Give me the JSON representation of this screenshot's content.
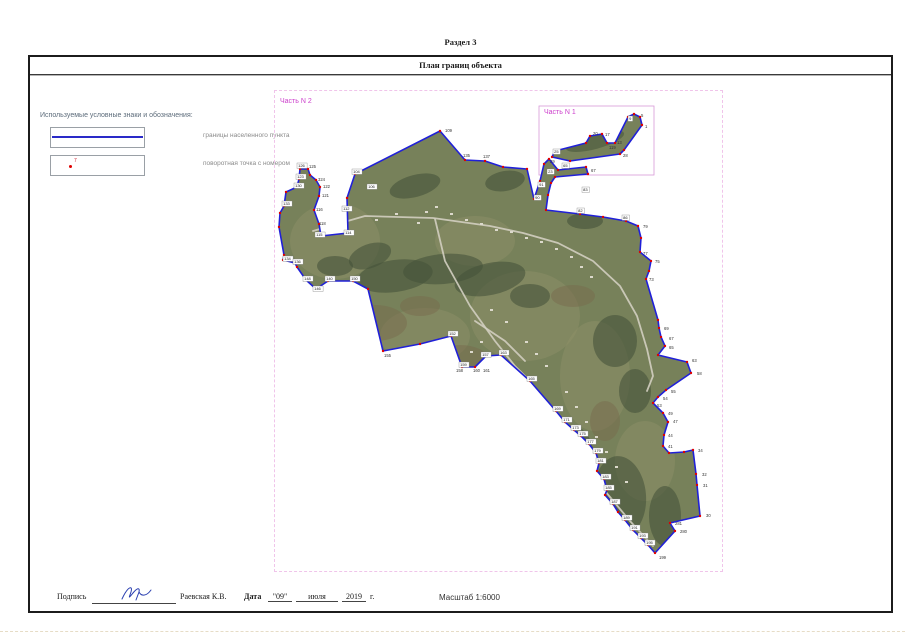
{
  "page": {
    "section_title": "Раздел 3",
    "band_title": "План границ объекта"
  },
  "legend": {
    "title": "Используемые условные знаки и обозначения:",
    "items": [
      {
        "label": "границы населенного пункта",
        "symbol": "boundary-line"
      },
      {
        "label": "поворотная точка с номером",
        "symbol": "turn-point",
        "point_number": "7"
      }
    ]
  },
  "map": {
    "part2_label": "Часть N 2",
    "part1_label": "Часть N 1",
    "colors": {
      "frame": "#f0c4ea",
      "part1_box": "#d898d8",
      "boundary": "#2020d8",
      "point": "#e00000",
      "base": "#77815a",
      "field": "#8d9067",
      "patch": "#77684c",
      "forest": "#46543a",
      "road": "#d2cec0",
      "building": "#dcd9cc"
    },
    "part1_box": {
      "x": 264,
      "y": 15,
      "w": 115,
      "h": 69
    },
    "main_polygon": [
      [
        165,
        40
      ],
      [
        190,
        69
      ],
      [
        210,
        70
      ],
      [
        228,
        76
      ],
      [
        252,
        78
      ],
      [
        259,
        108
      ],
      [
        265,
        90
      ],
      [
        269,
        73
      ],
      [
        274,
        68
      ],
      [
        283,
        79
      ],
      [
        311,
        76
      ],
      [
        313,
        83
      ],
      [
        280,
        86
      ],
      [
        276,
        92
      ],
      [
        273,
        104
      ],
      [
        271,
        119
      ],
      [
        305,
        123
      ],
      [
        328,
        126
      ],
      [
        351,
        130
      ],
      [
        363,
        135
      ],
      [
        366,
        147
      ],
      [
        365,
        161
      ],
      [
        376,
        170
      ],
      [
        374,
        180
      ],
      [
        371,
        188
      ],
      [
        383,
        229
      ],
      [
        384,
        237
      ],
      [
        386,
        246
      ],
      [
        390,
        255
      ],
      [
        383,
        264
      ],
      [
        412,
        271
      ],
      [
        416,
        282
      ],
      [
        391,
        299
      ],
      [
        383,
        306
      ],
      [
        378,
        312
      ],
      [
        388,
        322
      ],
      [
        393,
        331
      ],
      [
        389,
        344
      ],
      [
        388,
        355
      ],
      [
        394,
        362
      ],
      [
        409,
        361
      ],
      [
        418,
        359
      ],
      [
        421,
        383
      ],
      [
        422,
        394
      ],
      [
        425,
        425
      ],
      [
        395,
        432
      ],
      [
        400,
        440
      ],
      [
        380,
        462
      ],
      [
        373,
        454
      ],
      [
        366,
        447
      ],
      [
        358,
        439
      ],
      [
        350,
        429
      ],
      [
        343,
        421
      ],
      [
        338,
        413
      ],
      [
        330,
        404
      ],
      [
        332,
        399
      ],
      [
        329,
        388
      ],
      [
        322,
        380
      ],
      [
        324,
        372
      ],
      [
        321,
        362
      ],
      [
        314,
        353
      ],
      [
        306,
        345
      ],
      [
        299,
        339
      ],
      [
        290,
        331
      ],
      [
        281,
        320
      ],
      [
        255,
        290
      ],
      [
        226,
        264
      ],
      [
        211,
        265
      ],
      [
        200,
        276
      ],
      [
        187,
        276
      ],
      [
        176,
        245
      ],
      [
        145,
        253
      ],
      [
        108,
        260
      ],
      [
        93,
        198
      ],
      [
        78,
        190
      ],
      [
        53,
        190
      ],
      [
        41,
        198
      ],
      [
        31,
        189
      ],
      [
        22,
        176
      ],
      [
        20,
        172
      ],
      [
        8,
        169
      ],
      [
        9,
        164
      ],
      [
        4,
        136
      ],
      [
        5,
        122
      ],
      [
        9,
        115
      ],
      [
        11,
        101
      ],
      [
        22,
        96
      ],
      [
        24,
        88
      ],
      [
        25,
        78
      ],
      [
        33,
        78
      ],
      [
        35,
        84
      ],
      [
        41,
        89
      ],
      [
        45,
        96
      ],
      [
        44,
        105
      ],
      [
        39,
        119
      ],
      [
        44,
        133
      ],
      [
        46,
        145
      ],
      [
        73,
        142
      ],
      [
        72,
        107
      ],
      [
        80,
        83
      ]
    ],
    "part1_polygon": [
      [
        277,
        66
      ],
      [
        280,
        60
      ],
      [
        311,
        52
      ],
      [
        315,
        45
      ],
      [
        327,
        43
      ],
      [
        332,
        52
      ],
      [
        340,
        52
      ],
      [
        353,
        26
      ],
      [
        359,
        23
      ],
      [
        365,
        26
      ],
      [
        367,
        34
      ],
      [
        349,
        59
      ],
      [
        345,
        63
      ],
      [
        295,
        70
      ]
    ],
    "fields": [
      [
        60,
        150,
        45,
        38,
        0
      ],
      [
        250,
        225,
        55,
        45,
        0
      ],
      [
        320,
        285,
        35,
        55,
        0
      ],
      [
        150,
        245,
        45,
        28,
        0
      ],
      [
        200,
        150,
        40,
        25,
        0
      ],
      [
        370,
        370,
        30,
        40,
        0
      ]
    ],
    "patches": [
      [
        100,
        232,
        32,
        18,
        0
      ],
      [
        185,
        268,
        28,
        14,
        0
      ],
      [
        298,
        205,
        22,
        11,
        0
      ],
      [
        145,
        215,
        20,
        10,
        0
      ],
      [
        330,
        330,
        15,
        20,
        0
      ]
    ],
    "forests": [
      [
        120,
        185,
        38,
        16,
        -8
      ],
      [
        168,
        178,
        40,
        15,
        -5
      ],
      [
        215,
        188,
        36,
        16,
        -12
      ],
      [
        255,
        205,
        20,
        12,
        0
      ],
      [
        95,
        165,
        22,
        12,
        -20
      ],
      [
        340,
        250,
        22,
        26,
        0
      ],
      [
        360,
        300,
        16,
        22,
        0
      ],
      [
        345,
        405,
        26,
        40,
        -5
      ],
      [
        390,
        425,
        16,
        30,
        0
      ],
      [
        300,
        360,
        18,
        25,
        -10
      ],
      [
        140,
        95,
        26,
        11,
        -15
      ],
      [
        60,
        175,
        18,
        10,
        0
      ],
      [
        230,
        90,
        20,
        10,
        -10
      ],
      [
        310,
        130,
        18,
        8,
        0
      ]
    ],
    "part1_forest": [
      320,
      50,
      30,
      8,
      -15
    ],
    "roads": [
      "38,140 90,125 158,127 215,135 248,142 283,152 318,170 345,195 362,225 372,258 378,285 372,300",
      "160,128 170,170 195,215 220,250 240,275 255,290",
      "290,330 310,365 330,400 355,430 378,455",
      "200,230 230,250 250,270"
    ],
    "buildings": [
      [
        150,
        120
      ],
      [
        160,
        115
      ],
      [
        175,
        122
      ],
      [
        190,
        128
      ],
      [
        205,
        132
      ],
      [
        142,
        131
      ],
      [
        120,
        122
      ],
      [
        100,
        128
      ],
      [
        220,
        138
      ],
      [
        235,
        140
      ],
      [
        250,
        146
      ],
      [
        265,
        150
      ],
      [
        280,
        157
      ],
      [
        295,
        165
      ],
      [
        305,
        175
      ],
      [
        315,
        185
      ],
      [
        290,
        300
      ],
      [
        300,
        315
      ],
      [
        310,
        330
      ],
      [
        320,
        345
      ],
      [
        330,
        360
      ],
      [
        340,
        375
      ],
      [
        350,
        390
      ],
      [
        250,
        250
      ],
      [
        260,
        262
      ],
      [
        270,
        274
      ],
      [
        230,
        230
      ],
      [
        215,
        218
      ],
      [
        205,
        250
      ],
      [
        195,
        260
      ]
    ],
    "labels": [
      [
        170,
        41,
        "109",
        0
      ],
      [
        188,
        66,
        "135",
        0
      ],
      [
        208,
        67,
        "137",
        0
      ],
      [
        368,
        137,
        "79",
        0
      ],
      [
        368,
        164,
        "77",
        0
      ],
      [
        380,
        172,
        "75",
        0
      ],
      [
        374,
        190,
        "73",
        0
      ],
      [
        389,
        239,
        "69",
        0
      ],
      [
        394,
        249,
        "67",
        0
      ],
      [
        394,
        258,
        "65",
        0
      ],
      [
        417,
        271,
        "63",
        0
      ],
      [
        422,
        284,
        "58",
        0
      ],
      [
        396,
        302,
        "55",
        0
      ],
      [
        388,
        309,
        "54",
        0
      ],
      [
        382,
        316,
        "53",
        0
      ],
      [
        393,
        324,
        "49",
        0
      ],
      [
        398,
        332,
        "47",
        0
      ],
      [
        393,
        346,
        "44",
        0
      ],
      [
        393,
        357,
        "41",
        0
      ],
      [
        423,
        361,
        "34",
        0
      ],
      [
        427,
        385,
        "32",
        0
      ],
      [
        428,
        396,
        "31",
        0
      ],
      [
        431,
        426,
        "30",
        0
      ],
      [
        400,
        434,
        "281",
        0
      ],
      [
        405,
        442,
        "280",
        0
      ],
      [
        384,
        468,
        "199",
        0
      ],
      [
        47,
        106,
        "121",
        0
      ],
      [
        48,
        97,
        "122",
        0
      ],
      [
        43,
        90,
        "324",
        0
      ],
      [
        34,
        77,
        "125",
        0
      ],
      [
        41,
        120,
        "116",
        0
      ],
      [
        44,
        134,
        "118",
        0
      ],
      [
        109,
        266,
        "155",
        0
      ],
      [
        181,
        281,
        "158",
        0
      ],
      [
        198,
        281,
        "160",
        0
      ],
      [
        208,
        281,
        "161",
        0
      ],
      [
        316,
        81,
        "67",
        0
      ],
      [
        318,
        44,
        "20",
        0
      ],
      [
        330,
        45,
        "17",
        0
      ],
      [
        334,
        58,
        "119",
        0
      ],
      [
        342,
        53,
        "13",
        0
      ],
      [
        366,
        26,
        "5",
        0
      ],
      [
        370,
        37,
        "1",
        0
      ],
      [
        348,
        66,
        "28",
        0
      ],
      [
        275,
        72,
        "29",
        0
      ],
      [
        22,
        72,
        "126",
        1
      ],
      [
        21,
        83,
        "123",
        1
      ],
      [
        19,
        92,
        "130",
        1
      ],
      [
        7,
        110,
        "133",
        1
      ],
      [
        40,
        141,
        "115",
        1
      ],
      [
        67,
        115,
        "112",
        1
      ],
      [
        69,
        139,
        "114",
        1
      ],
      [
        8,
        165,
        "134",
        1
      ],
      [
        18,
        168,
        "136",
        1
      ],
      [
        28,
        185,
        "148",
        1
      ],
      [
        38,
        195,
        "146",
        1
      ],
      [
        50,
        185,
        "140",
        1
      ],
      [
        75,
        185,
        "150",
        1
      ],
      [
        173,
        240,
        "152",
        1
      ],
      [
        184,
        271,
        "159",
        1
      ],
      [
        206,
        261,
        "157",
        1
      ],
      [
        224,
        259,
        "163",
        1
      ],
      [
        252,
        285,
        "165",
        1
      ],
      [
        278,
        315,
        "169",
        1
      ],
      [
        287,
        326,
        "171",
        1
      ],
      [
        296,
        334,
        "173",
        1
      ],
      [
        303,
        340,
        "175",
        1
      ],
      [
        311,
        348,
        "177",
        1
      ],
      [
        318,
        357,
        "179",
        1
      ],
      [
        321,
        367,
        "181",
        1
      ],
      [
        326,
        383,
        "183",
        1
      ],
      [
        329,
        394,
        "185",
        1
      ],
      [
        335,
        408,
        "187",
        1
      ],
      [
        347,
        424,
        "189",
        1
      ],
      [
        355,
        434,
        "191",
        1
      ],
      [
        363,
        442,
        "193",
        1
      ],
      [
        370,
        449,
        "195",
        1
      ],
      [
        307,
        96,
        "83",
        1
      ],
      [
        302,
        117,
        "82",
        1
      ],
      [
        347,
        124,
        "86",
        1
      ],
      [
        263,
        91,
        "91",
        1
      ],
      [
        259,
        104,
        "90",
        1
      ],
      [
        287,
        72,
        "65",
        1
      ],
      [
        272,
        78,
        "23",
        1
      ],
      [
        77,
        78,
        "104",
        1
      ],
      [
        92,
        93,
        "106",
        1
      ],
      [
        353,
        25,
        "9",
        1
      ],
      [
        278,
        58,
        "25",
        1
      ]
    ]
  },
  "footer": {
    "signature_label": "Подпись",
    "signature_name": "Раевская К.В.",
    "date_label": "Дата",
    "date_day_display": "\"09\"",
    "date_month": "июля",
    "date_year": "2019",
    "year_suffix": "г.",
    "scale_label": "Масштаб 1:6000"
  }
}
